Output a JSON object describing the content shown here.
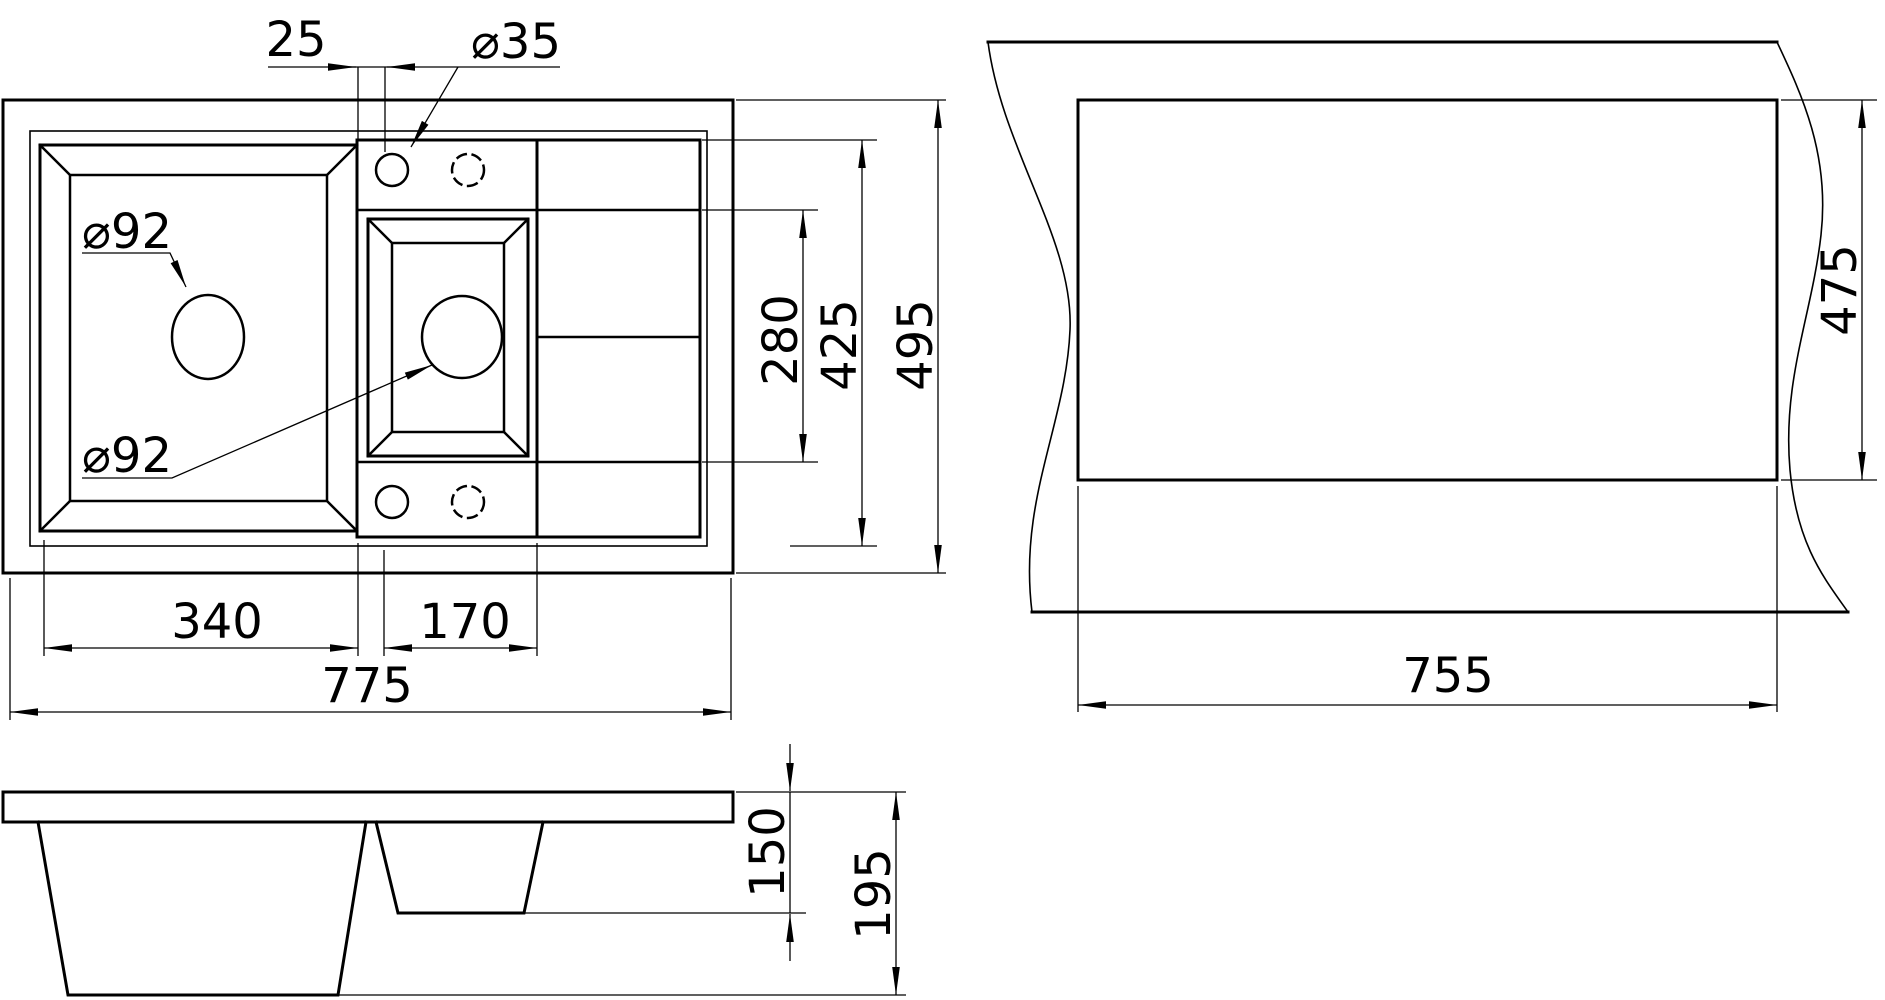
{
  "drawing": {
    "type": "technical-dimension-drawing",
    "subject": "kitchen sink with one and a half bowls and drainboard",
    "background_color": "#ffffff",
    "line_color": "#000000",
    "views": {
      "plan": {
        "name": "sink top view",
        "dims": {
          "faucet_offset": "25",
          "faucet_hole_diameter": "⌀35",
          "main_drain_diameter": "⌀92",
          "secondary_drain_diameter": "⌀92",
          "drainboard_section_depth": "280",
          "bowl_area_depth": "425",
          "overall_depth": "495",
          "main_bowl_width": "340",
          "secondary_bowl_width": "170",
          "overall_width": "775"
        }
      },
      "cutout": {
        "name": "countertop cutout view",
        "dims": {
          "cutout_width": "755",
          "cutout_depth": "475"
        }
      },
      "section": {
        "name": "side section view",
        "dims": {
          "secondary_bowl_depth": "150",
          "main_bowl_depth": "195"
        }
      }
    }
  }
}
